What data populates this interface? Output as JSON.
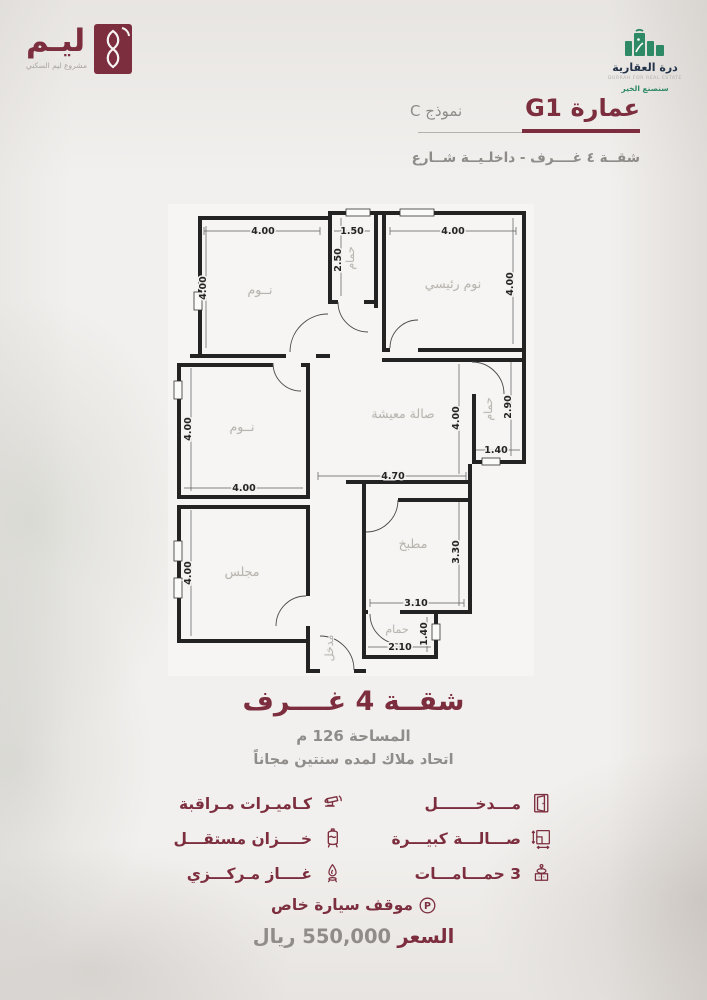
{
  "colors": {
    "maroon": "#7C2E3E",
    "gray": "#8f8c89",
    "navy": "#233349",
    "green": "#2E8A66"
  },
  "brand_left": {
    "name": "ليـم",
    "tagline": "مشروع ليم السكني"
  },
  "brand_right": {
    "name": "درة العقارية",
    "subtitle": "DURRAH FOR REAL ESTATE",
    "tagline": "سنصنع الخير"
  },
  "header": {
    "title": "عمارة G1",
    "model": "نموذج C",
    "subtitle": "شقــة ٤ غــــرف - داخلـيــة شــارع"
  },
  "plan": {
    "rooms": {
      "bedroom_tl": "نــوم",
      "bath_top": "حمام",
      "master_bedroom": "نوم رئيسي",
      "bedroom_ml": "نــوم",
      "living": "صالة معيشة",
      "bath_right": "حمام",
      "majlis": "مجلس",
      "kitchen": "مطبخ",
      "bath_bottom": "حمام",
      "entrance": "مدخل"
    },
    "dims": {
      "tl_top": "4.00",
      "tl_left": "4.00",
      "bath_top_w": "1.50",
      "bath_top_h": "2.50",
      "master_top": "4.00",
      "master_right": "4.00",
      "ml_left": "4.00",
      "ml_bottom": "4.00",
      "living_right": "4.00",
      "living_bottom": "4.70",
      "bath_right_h": "2.90",
      "bath_right_w": "1.40",
      "majlis_left": "4.00",
      "kitchen_right": "3.30",
      "kitchen_bottom": "3.10",
      "bath_bottom_h": "1.40",
      "bath_bottom_w": "2.10"
    }
  },
  "summary": {
    "title": "شقــة 4 غــــرف",
    "area": "المساحة 126 م",
    "note": "اتحاد ملاك لمده سنتين مجاناً"
  },
  "features": {
    "col_right": [
      {
        "icon": "door-icon",
        "label": "مـــدخـــــــل"
      },
      {
        "icon": "sofa-icon",
        "label": "صـــالـــة كبيـــرة"
      },
      {
        "icon": "sink-icon",
        "label": "3 حمـــامـــات"
      }
    ],
    "col_left": [
      {
        "icon": "cctv-icon",
        "label": "كـاميـرات مـراقبة"
      },
      {
        "icon": "tank-icon",
        "label": "خــــزان مستقـــل"
      },
      {
        "icon": "gas-icon",
        "label": "غــــاز مـركـــزي"
      }
    ],
    "parking_symbol": "P",
    "parking": "موقف سيارة خاص"
  },
  "price": {
    "label": "السعر",
    "value": "550,000 ريال"
  }
}
